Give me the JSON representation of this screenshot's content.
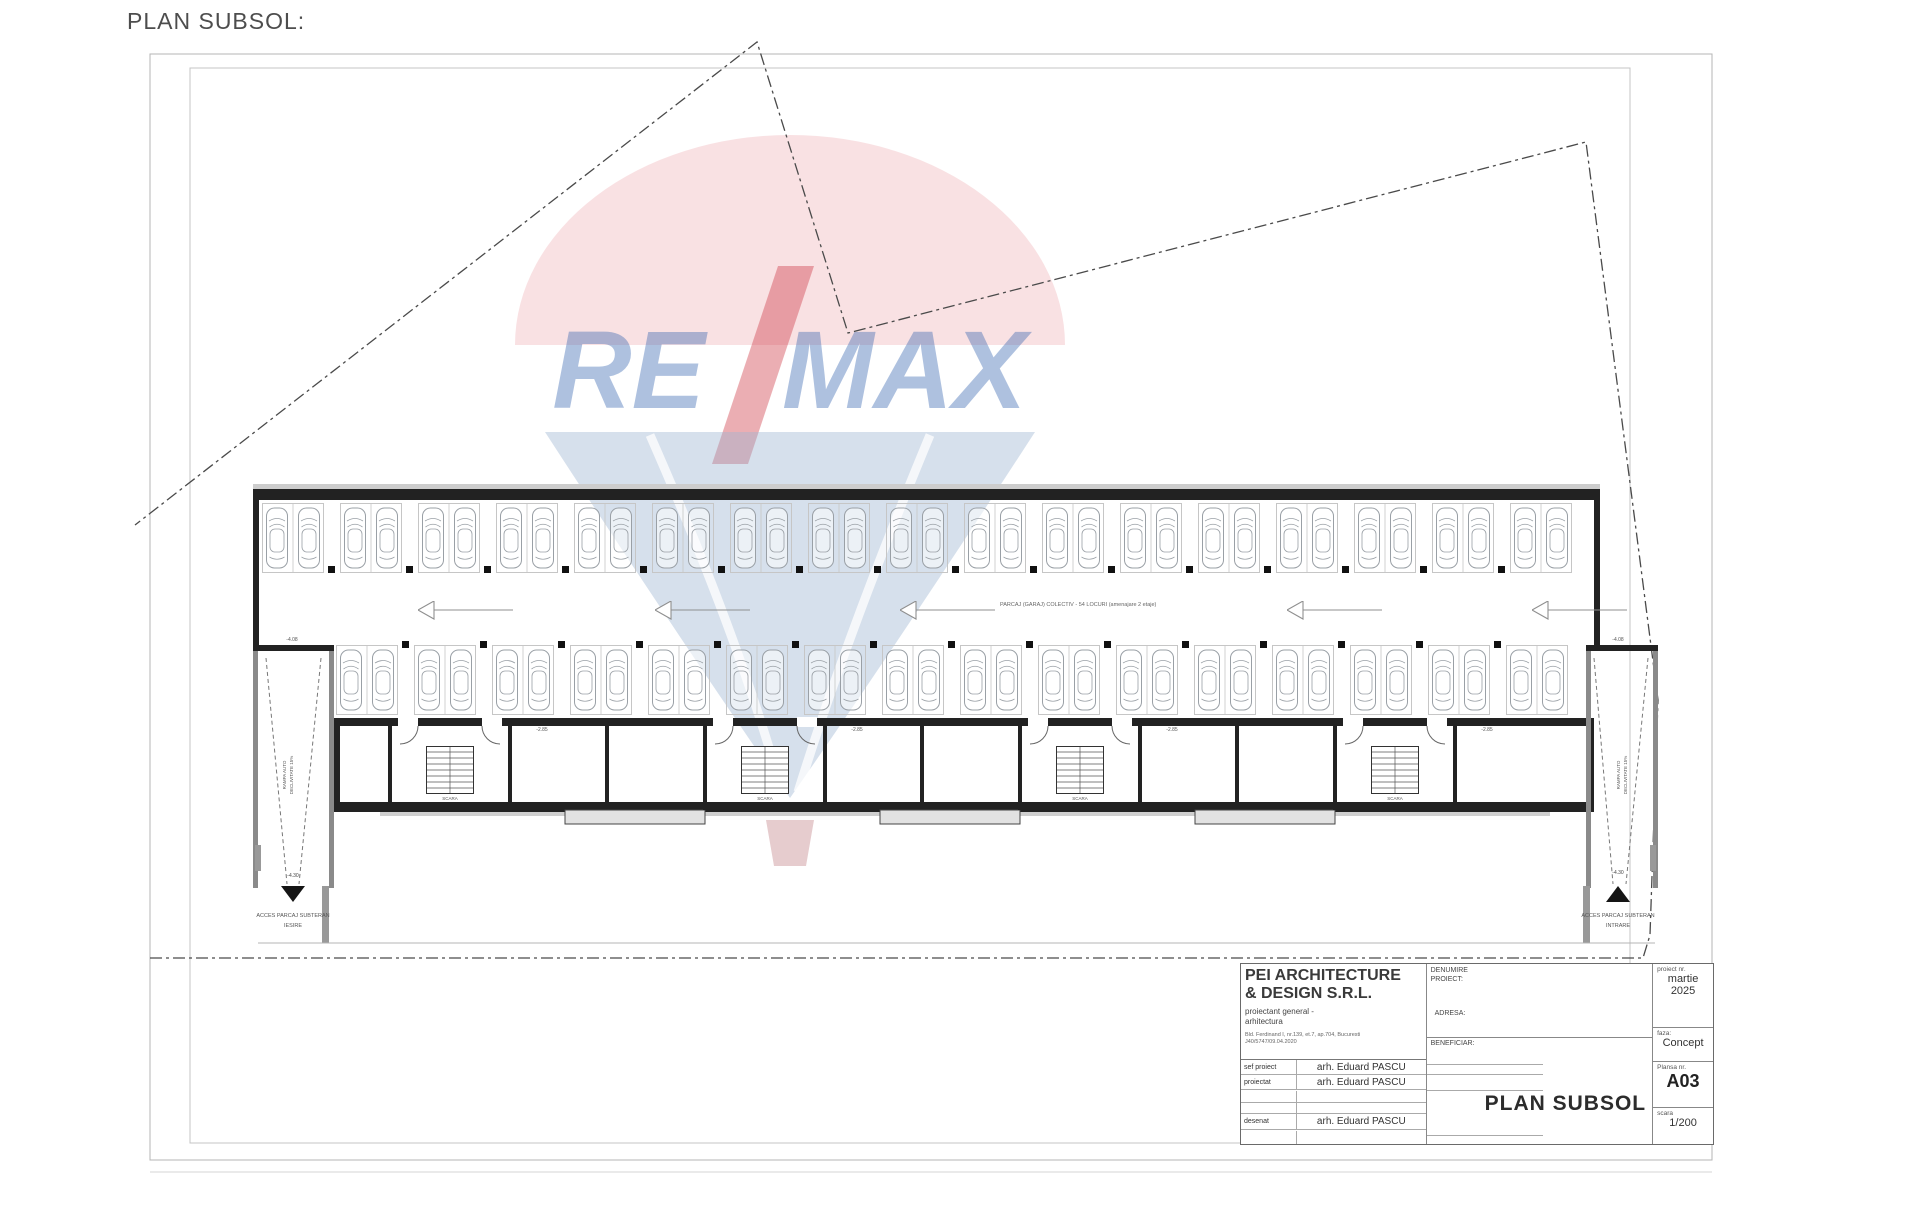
{
  "page": {
    "heading": "PLAN SUBSOL:"
  },
  "watermark": {
    "re": "RE",
    "max": "MAX"
  },
  "plan": {
    "aisle_label": "PARCAJ (GARAJ) COLECTIV - 54 LOCURI (amenajare 2 etaje)",
    "ramp_label_line1": "RAMPA AUTO",
    "ramp_label_line2": "DECLIVITATE 15%",
    "stair_label": "SCARA",
    "elev_ramp_top": "-4.08",
    "elev_access": "-4.30",
    "elev_unit": "-2.85",
    "access_line1": "ACCES PARCAJ SUBTERAN",
    "access_left_line2": "IESIRE",
    "access_right_line2": "INTRARE"
  },
  "title_block": {
    "company_line1": "PEI ARCHITECTURE",
    "company_line2": "& DESIGN S.R.L.",
    "role_line1": "proiectant general -",
    "role_line2": "arhitectura",
    "address_line1": "Bld. Ferdinand I, nr.139, et.7, ap.704, Bucuresti",
    "address_line2": "J40/5747/09.04.2020",
    "labels": {
      "project": "DENUMIRE PROIECT:",
      "address": "ADRESA:",
      "beneficiary": "BENEFICIAR:",
      "project_no": "proiect nr.",
      "phase": "faza:",
      "sheet_no_label": "Plansa nr.",
      "scale_label": "scara"
    },
    "rows": [
      {
        "label": "sef proiect",
        "value": "arh. Eduard PASCU"
      },
      {
        "label": "proiectat",
        "value": "arh. Eduard PASCU"
      },
      {
        "label": "desenat",
        "value": "arh. Eduard PASCU"
      }
    ],
    "date": "martie 2025",
    "phase_value": "Concept",
    "sheet_title": "PLAN SUBSOL",
    "sheet_no": "A03",
    "scale": "1/200"
  }
}
